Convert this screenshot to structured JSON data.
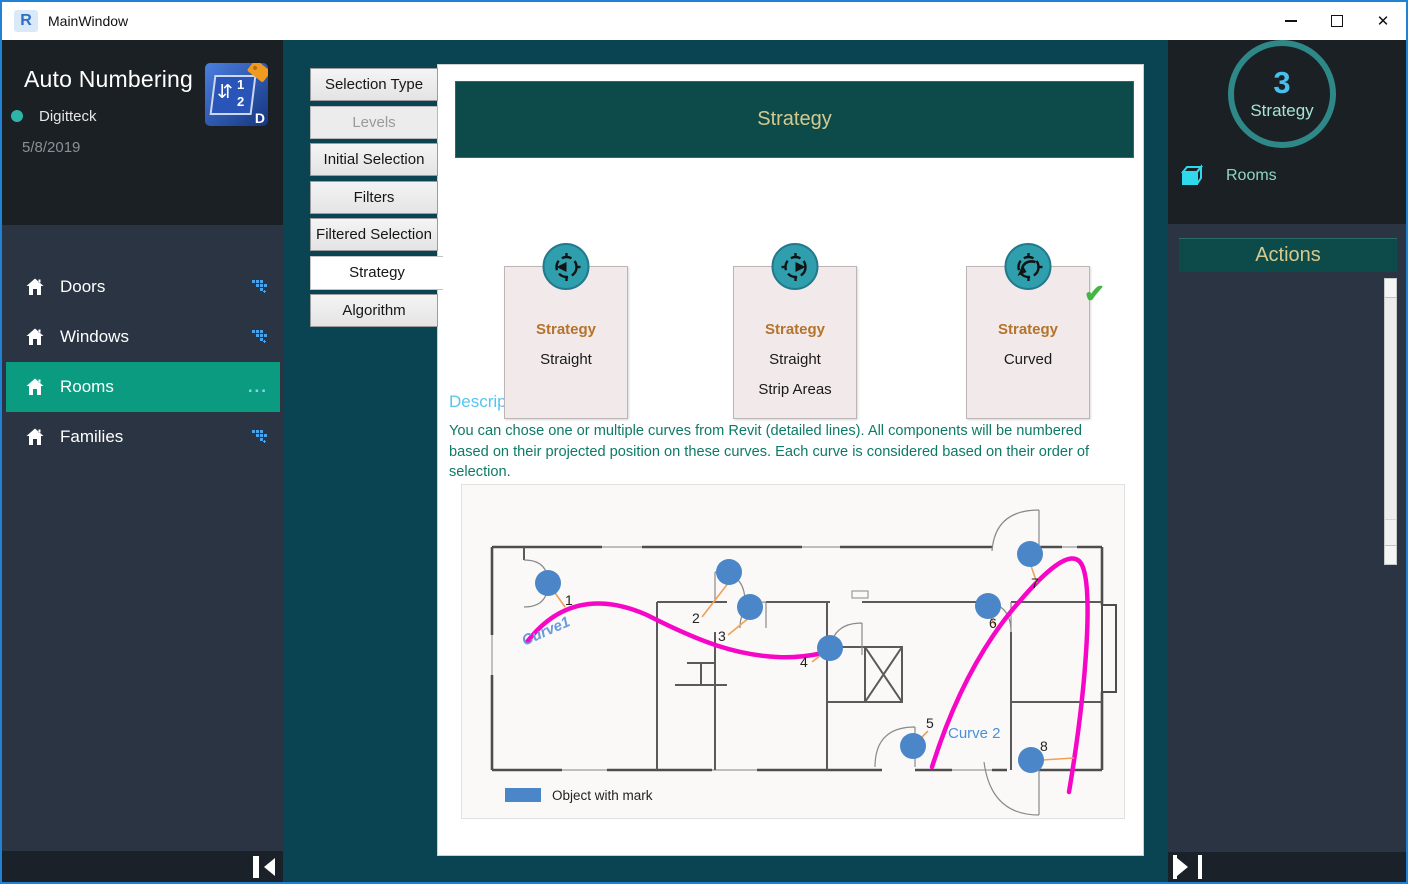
{
  "window": {
    "title": "MainWindow",
    "app_icon_letter": "R"
  },
  "icons": {
    "close": "✕",
    "ellipsis": "...",
    "swap": "⇵",
    "check": "✔"
  },
  "sidebar": {
    "title": "Auto Numbering",
    "author": "Digitteck",
    "date": "5/8/2019",
    "logo": {
      "digit_top": "1",
      "digit_bottom": "2",
      "corner_letter": "D"
    },
    "items": [
      {
        "label": "Doors",
        "selected": false
      },
      {
        "label": "Windows",
        "selected": false
      },
      {
        "label": "Rooms",
        "selected": true
      },
      {
        "label": "Families",
        "selected": false
      }
    ]
  },
  "tabs": [
    {
      "label": "Selection Type"
    },
    {
      "label": "Levels",
      "disabled": true
    },
    {
      "label": "Initial Selection"
    },
    {
      "label": "Filters"
    },
    {
      "label": "Filtered Selection"
    },
    {
      "label": "Strategy",
      "selected": true
    },
    {
      "label": "Algorithm"
    }
  ],
  "main": {
    "banner": "Strategy",
    "cards": [
      {
        "title": "Strategy",
        "lines": [
          "Straight"
        ]
      },
      {
        "title": "Strategy",
        "lines": [
          "Straight",
          "Strip Areas"
        ]
      },
      {
        "title": "Strategy",
        "lines": [
          "Curved"
        ],
        "selected": true
      }
    ],
    "description": {
      "title": "Description",
      "text": "You can chose one or multiple curves from Revit (detailed lines). All components will be numbered based on their projected position on these curves. Each curve is considered based on their order of selection."
    },
    "plan": {
      "markers": [
        "1",
        "2",
        "3",
        "4",
        "5",
        "6",
        "7",
        "8"
      ],
      "curve1_label": "Curve1",
      "curve2_label": "Curve 2",
      "legend_label": "Object with mark"
    }
  },
  "rightbar": {
    "badge_value": "3",
    "badge_label": "Strategy",
    "category_label": "Rooms",
    "actions_label": "Actions"
  },
  "colors": {
    "accent_green": "#0b9b80",
    "deep_teal": "#0a4452",
    "banner_teal": "#0d4b4b",
    "banner_text": "#d6c98c",
    "marker_blue": "#4a86c8",
    "curve_magenta": "#f607c8"
  }
}
